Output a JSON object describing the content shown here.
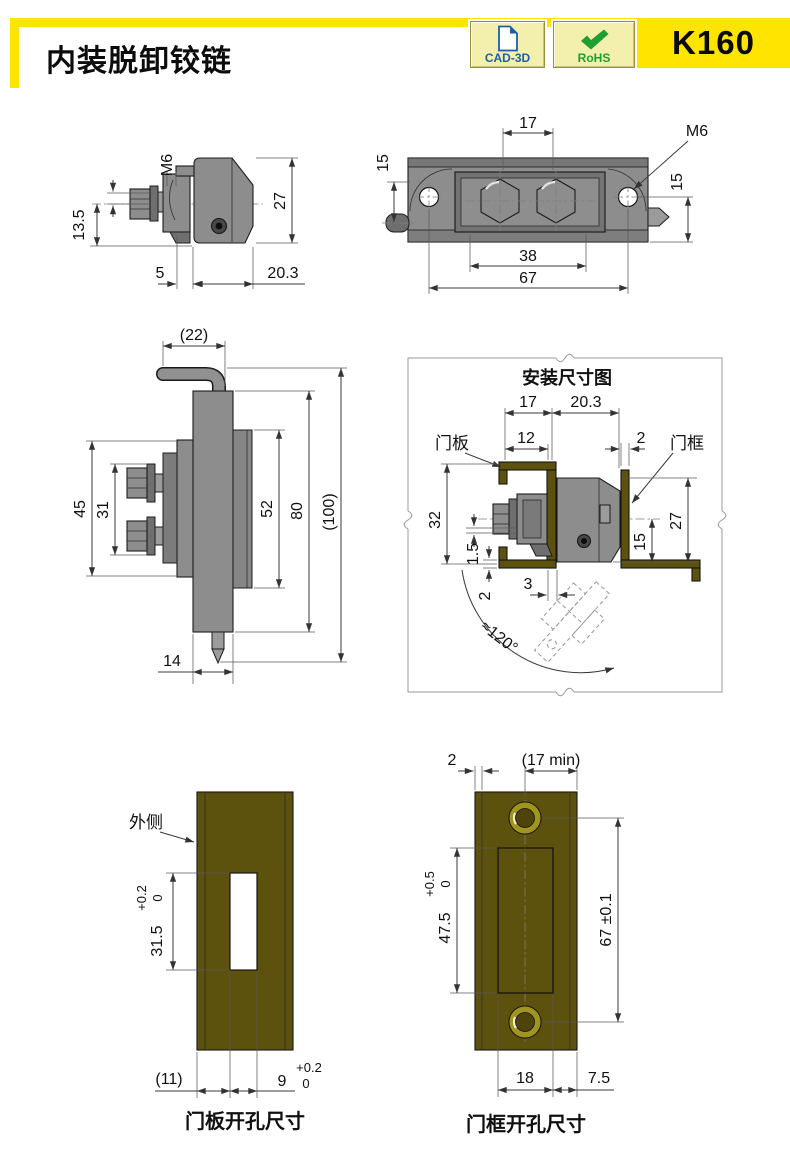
{
  "header": {
    "title": "内装脱卸铰链",
    "part_code": "K160",
    "badges": [
      {
        "label": "CAD-3D"
      },
      {
        "label": "RoHS"
      }
    ]
  },
  "colors": {
    "accent_yellow": "#FFE400",
    "badge_bg": "#F3EFAC",
    "cad_blue": "#1E5FA8",
    "rohs_green": "#1F9E33",
    "metal_gray": "#8D8D8D",
    "plate_olive": "#5C510D",
    "line_dark": "#1A1A1A"
  },
  "views": {
    "side_detail": {
      "dims": {
        "m6": "M6",
        "h13_5": "13.5",
        "h27": "27",
        "w5": "5",
        "w20_3": "20.3"
      }
    },
    "front": {
      "dims": {
        "w17": "17",
        "m6": "M6",
        "h15_left": "15",
        "h15_right": "15",
        "w38": "38",
        "w67": "67"
      }
    },
    "side_full": {
      "dims": {
        "w22": "(22)",
        "h45": "45",
        "h31": "31",
        "h52": "52",
        "h80": "80",
        "h100": "(100)",
        "w14": "14"
      }
    },
    "installation": {
      "title": "安装尺寸图",
      "labels": {
        "door_panel": "门板",
        "door_frame": "门框"
      },
      "dims": {
        "w17": "17",
        "w20_3": "20.3",
        "w12": "12",
        "t2_top": "2",
        "h32": "32",
        "g1_5": "1.5",
        "t2_bottom": "2",
        "w3": "3",
        "h15": "15",
        "h27": "27",
        "angle": "≈120°"
      }
    },
    "panel_cutout": {
      "caption": "门板开孔尺寸",
      "label_outside": "外侧",
      "dims": {
        "h31_5": "31.5",
        "h_tol_up": "+0.2",
        "h_tol_low": "0",
        "w11": "(11)",
        "w9": "9",
        "w9_tol_up": "+0.2",
        "w9_tol_low": "0"
      }
    },
    "frame_cutout": {
      "caption": "门框开孔尺寸",
      "dims": {
        "t2": "2",
        "w17min": "(17 min)",
        "h47_5": "47.5",
        "h_tol_up": "+0.5",
        "h_tol_low": "0",
        "h67": "67 ±0.1",
        "w18": "18",
        "w7_5": "7.5"
      }
    }
  }
}
